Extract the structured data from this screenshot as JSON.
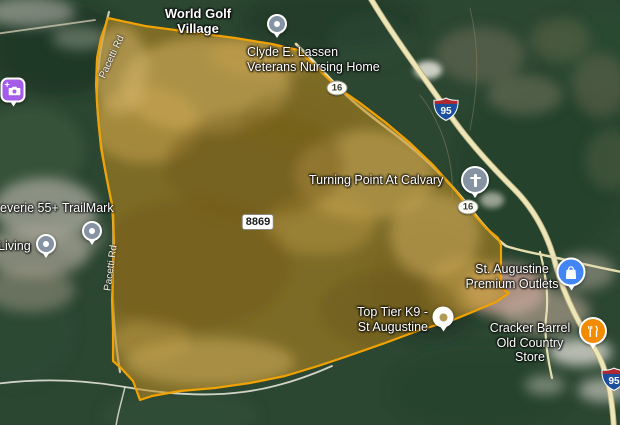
{
  "map": {
    "locality_label": "World Golf\nVillage",
    "region": {
      "parcel_label": "8869",
      "boundary_color": "#F0A202",
      "fill_color": "#C08A1E"
    },
    "places": {
      "clyde_lassen": "Clyde E. Lassen\nVeterans Nursing Home",
      "turning_point": "Turning Point At Calvary",
      "trailmark": "everie 55+ TrailMark",
      "living": "Living",
      "top_tier_k9": "Top Tier K9 -\nSt Augustine",
      "premium_outlets": "St. Augustine\nPremium Outlets",
      "cracker_barrel": "Cracker Barrel\nOld Country Store"
    },
    "road_labels": {
      "pacetti_north": "Pacetti Rd",
      "pacetti_south": "Pacetti Rd"
    },
    "shields": {
      "interstate_95": "95",
      "interstate_95_edge": "95",
      "route_16_north": "16",
      "route_16_south": "16"
    },
    "colors": {
      "poi_pin_gray": "#8593A2",
      "shopping_pin_blue": "#4285F4",
      "dining_pin_orange": "#F28B00",
      "attraction_pin_purple": "#A55CE8",
      "interstate_shield_blue": "#1C4E9E",
      "interstate_shield_red": "#B3282D"
    }
  }
}
